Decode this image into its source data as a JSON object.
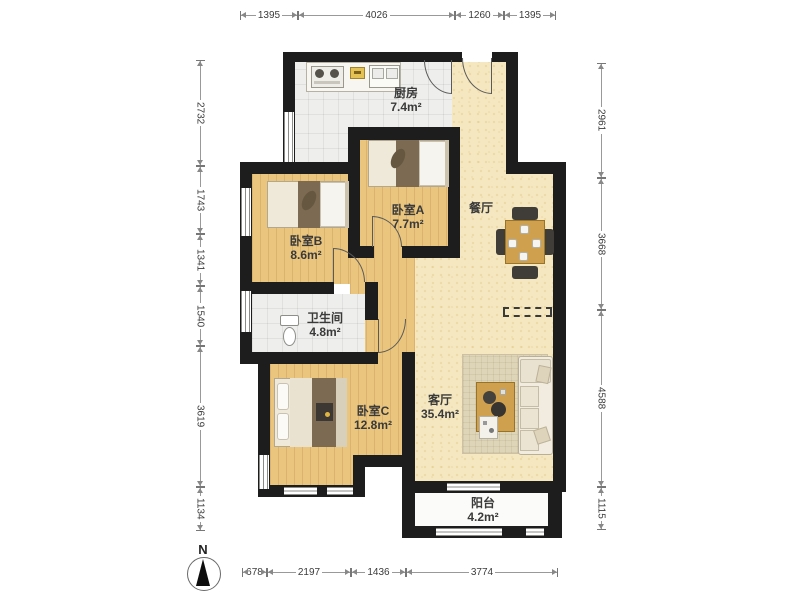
{
  "dims": {
    "top": [
      "1395",
      "4026",
      "1260",
      "1395"
    ],
    "bottom": [
      "678",
      "2197",
      "1436",
      "3774"
    ],
    "left": [
      "2732",
      "1743",
      "1341",
      "1540",
      "3619",
      "1134"
    ],
    "right": [
      "2961",
      "3668",
      "4588",
      "1115"
    ]
  },
  "rooms": {
    "kitchen": {
      "name": "厨房",
      "area": "7.4m²"
    },
    "bedroom_a": {
      "name": "卧室A",
      "area": "7.7m²"
    },
    "bedroom_b": {
      "name": "卧室B",
      "area": "8.6m²"
    },
    "dining": {
      "name": "餐厅"
    },
    "bathroom": {
      "name": "卫生间",
      "area": "4.8m²"
    },
    "bedroom_c": {
      "name": "卧室C",
      "area": "12.8m²"
    },
    "living": {
      "name": "客厅",
      "area": "35.4m²"
    },
    "balcony": {
      "name": "阳台",
      "area": "4.2m²"
    }
  },
  "compass": {
    "label": "N"
  },
  "colors": {
    "wall": "#1d1d1d",
    "wood": "#eac57e",
    "hall": "#f5e8c1",
    "tile": "#eeeeec",
    "furniture-wood": "#cfa14e"
  }
}
